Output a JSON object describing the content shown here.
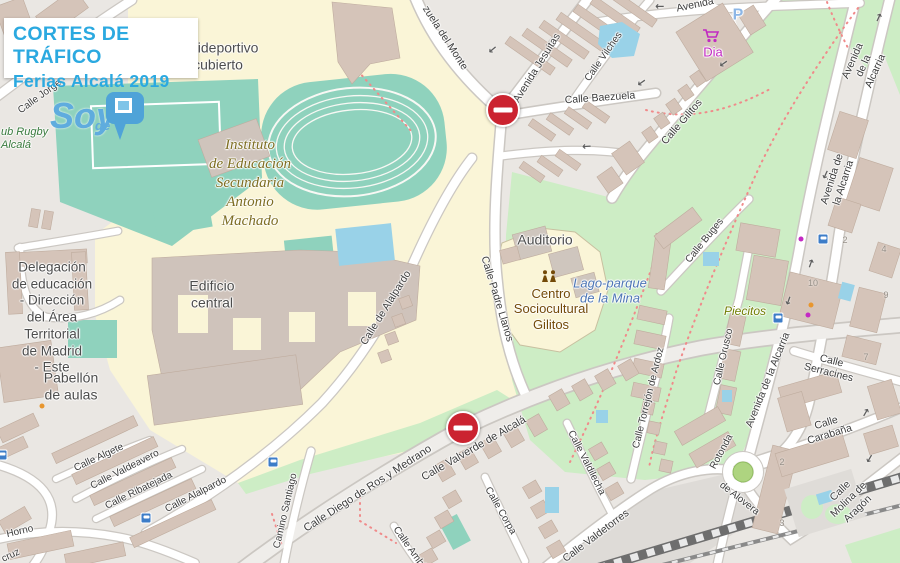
{
  "title": {
    "line1": "CORTES DE TRÁFICO",
    "line2": "Ferias Alcalá 2019"
  },
  "logo": {
    "soy": "Soy",
    "de": "de"
  },
  "areas": {
    "polideportivo": "Polideportivo\ncubierto",
    "instituto": "Instituto\nde Educación\nSecundaria\nAntonio\nMachado",
    "edificio_central": "Edificio\ncentral",
    "delegacion": "Delegación\nde educación\n- Dirección\ndel Área\nTerritorial\nde Madrid\n- Este",
    "pabellon": "Pabellón\nde aulas",
    "auditorio": "Auditorio",
    "centro_gilitos": "Centro\nSociocultural\nGilitos",
    "lago_parque": "Lago-parque\nde la Mina",
    "club_rugby": "ub Rugby\nAlcalá",
    "dia": "Dia",
    "piecitos": "Piecitos",
    "parking": "P"
  },
  "streets": {
    "jorge": "Calle Jorge",
    "monte": "zuela del Monte",
    "jesuitas": "Avenida Jesuitas",
    "avenida_top": "Avenida",
    "vilches": "Calle Vilches",
    "baezuela": "Calle Baezuela",
    "gilitos": "Calle Gilitos",
    "alcarria1": "Avenida de la Alcarria",
    "alcarria2": "Avenida de la Alcarria",
    "alcarria3": "Avenida de la Alcarria",
    "buges": "Calle Buges",
    "orusco": "Calle Orusco",
    "torrejon": "Calle Torrejón de Ardoz",
    "serracines": "Calle Serracines",
    "carabana": "Calle Carabaña",
    "molina": "Calle Molina de Aragón",
    "rotonda1": "Rotonda",
    "rotonda2": "de Alovera",
    "valdetorres": "Calle Valdetorres",
    "valverde": "Calle Valverde de Alcalá",
    "diego": "Calle Diego de Ros y Medrano",
    "santiago": "Camino Santiago",
    "alalpardo_ne": "Calle de Alalpardo",
    "padre_llanos": "Calle Padre Llanos",
    "algete": "Calle Algete",
    "valdeavero": "Calle Valdeavero",
    "ribatejada": "Calle Ribatejada",
    "alalpardo_s": "Calle Alalpardo",
    "horno": "Horno",
    "cruz": "cruz",
    "valdilecha": "Calle Valdilecha",
    "corpa": "Calle Corpa",
    "ambite": "Calle Ambite"
  },
  "house_numbers": {
    "hn1": "10",
    "hn2": "9",
    "hn3": "7",
    "hn4": "2",
    "hn5": "3",
    "hn6": "2",
    "hn7": "4"
  },
  "icons": {
    "arrow_glyph": "→"
  },
  "colors": {
    "accent_blue": "#2BA9E0",
    "no_entry_red": "#CB2330",
    "park_green": "#CDEDC5",
    "pitch_teal": "#8FD2BD",
    "school_yellow": "#FAF5D7",
    "building_tan": "#D5C4B9",
    "water_blue": "#99D2E8"
  }
}
